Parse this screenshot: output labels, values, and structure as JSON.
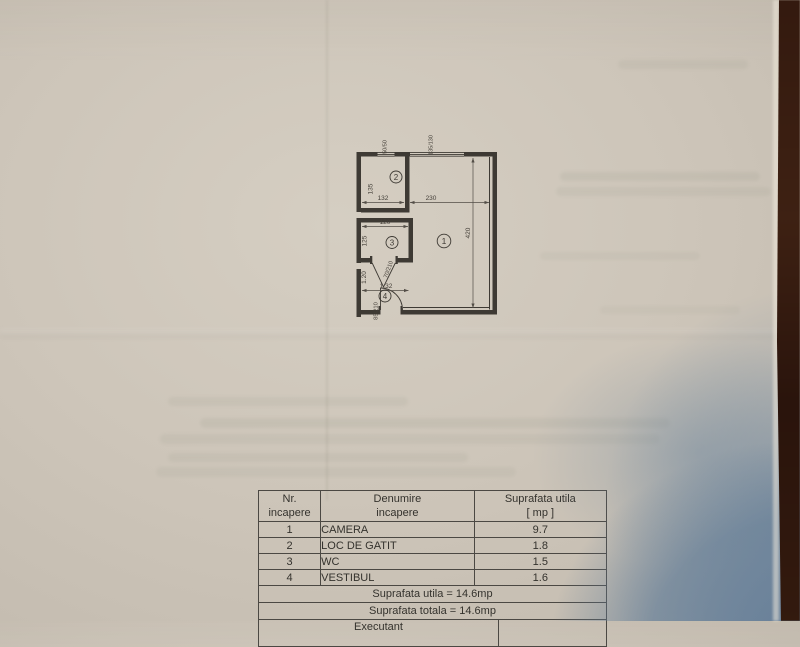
{
  "plan": {
    "room_numbers": {
      "r1": "1",
      "r2": "2",
      "r3": "3",
      "r4": "4"
    },
    "dims": {
      "room2_height": "135",
      "room2_width": "132",
      "room1_width": "230",
      "room1_height": "420",
      "room3_width": "120",
      "room3_height": "125",
      "room4_height": "1.20",
      "room4_width": "1.32"
    },
    "windows": {
      "left": "50/50",
      "right": "135/130"
    },
    "doors": {
      "wc": "70/210",
      "entry": "85/210"
    }
  },
  "table": {
    "headers": {
      "nr": "Nr.\nincapere",
      "name": "Denumire\nincapere",
      "area": "Suprafata utila\n[ mp ]"
    },
    "rows": [
      {
        "nr": "1",
        "name": "CAMERA",
        "area": "9.7"
      },
      {
        "nr": "2",
        "name": "LOC DE GATIT",
        "area": "1.8"
      },
      {
        "nr": "3",
        "name": "WC",
        "area": "1.5"
      },
      {
        "nr": "4",
        "name": "VESTIBUL",
        "area": "1.6"
      }
    ],
    "summary": {
      "utila": "Suprafata utila = 14.6mp",
      "totala": "Suprafata totala = 14.6mp",
      "executant": "Executant"
    }
  },
  "colors": {
    "paper": "#cdc5b9",
    "ink": "#3e3a34",
    "shadow_blue": "#7b90a5",
    "wood": "#2e1810"
  }
}
